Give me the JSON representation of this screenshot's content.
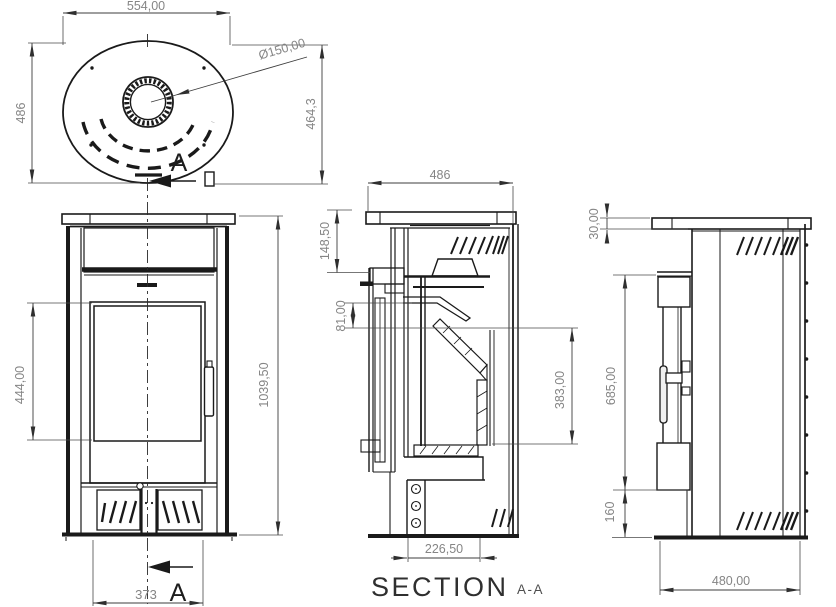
{
  "drawing": {
    "views": {
      "top": {
        "section_letter": "A",
        "dims": {
          "width": "554,00",
          "depth": "486",
          "diagonal": "464,3",
          "flue_diameter": "Ø150,00"
        }
      },
      "front": {
        "section_letter": "A",
        "dims": {
          "glass_height": "444,00",
          "total_height": "1039,50",
          "base_width": "373"
        }
      },
      "section": {
        "label": "SECTION",
        "label_suffix": "A-A",
        "dims": {
          "top_width": "486",
          "plate_offset": "148,50",
          "deflector_offset": "81,00",
          "firebox_height": "383,00",
          "base_width": "226,50"
        }
      },
      "side": {
        "dims": {
          "plate_thickness": "30,00",
          "door_top_height": "685,00",
          "door_bottom_height": "160",
          "depth": "480,00"
        }
      }
    },
    "colors": {
      "line": "#1a1a1a",
      "dim_text": "#858585",
      "label_text": "#2f2f2f"
    }
  }
}
